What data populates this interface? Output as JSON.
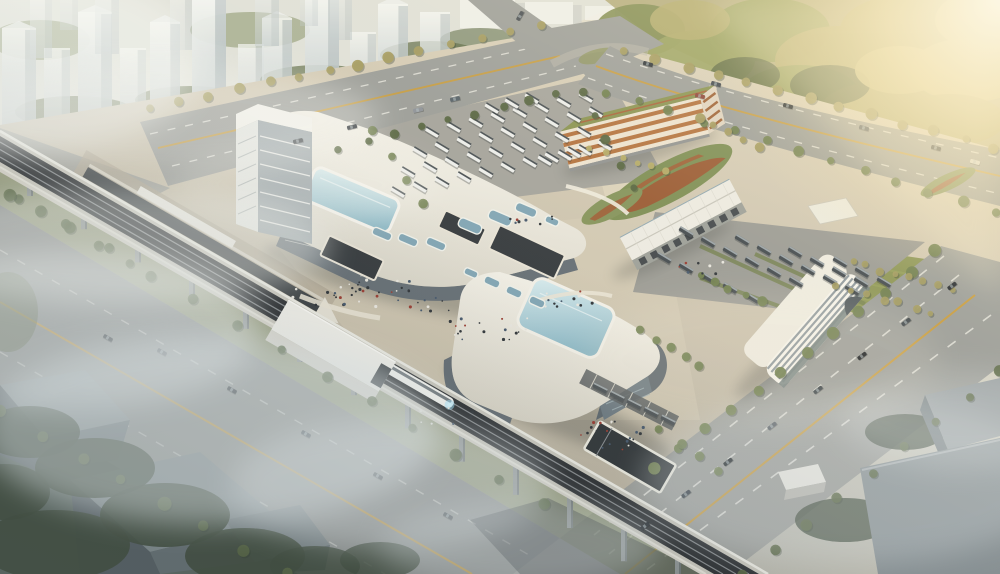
{
  "meta": {
    "label": "Aerial architectural rendering of an intermodal transit hub with two white terminal buildings, elevated railway viaduct with train, bus parking lots, parking garage, office block, roads, forest and hazy residential towers"
  },
  "palette": {
    "road": "#9a9c98",
    "roadDark": "#8b8e8c",
    "yellow": "#c79b3e",
    "dash": "#e8e7e0",
    "plazaHi": "#dcd2ba",
    "plazaLo": "#b8b1a1",
    "asphalt": "#a3a29b",
    "asphalt2": "#9a9a94",
    "grass": "#87914f",
    "grassDark": "#6f7c48",
    "treeDark": "#55643f",
    "treeDark2": "#3c4838",
    "treeMid": "#6e7d4c",
    "treeGold": "#a39a5e",
    "treeYellow": "#b5ab66",
    "f1": "#7f8a50",
    "f2": "#99a05f",
    "f3": "#b3ab6d",
    "f4": "#c7bb7a",
    "fSh": "#5a6741",
    "white": "#f2f1ea",
    "whiteDim": "#dcd9cf",
    "glass": "#646d74",
    "glassEnd": "#6b7880",
    "skyHi": "#d6e9ed",
    "skyLo": "#8fb9c6",
    "skylight": "#7fa4b4",
    "orange": "#b2703c",
    "track": "#2c2f32",
    "rail": "#85898c",
    "viaductSide": "#d5d2c8",
    "pier": "#8e9494",
    "busW": "#ecedeb",
    "busWTop": "#474e52",
    "busD": "#42494e",
    "busDTop": "#9aa3a7",
    "shed": "#eceae2",
    "shedFace": "#9b9e98",
    "door": "#41464a",
    "officeBand": "#8f999e",
    "towerSide": "#9aa6aa",
    "pit": "#33383c",
    "pitBorder": "#e8e3d6",
    "mound": "#7b8c52",
    "moundRed": "#9e4f2c"
  },
  "scene": {
    "towers": [
      [
        2,
        34,
        100,
        128,
        0.9,
        1
      ],
      [
        44,
        26,
        78,
        126,
        0.8,
        0
      ],
      [
        78,
        34,
        112,
        124,
        0.95,
        1
      ],
      [
        120,
        26,
        70,
        118,
        0.75,
        0
      ],
      [
        150,
        30,
        96,
        118,
        0.9,
        1
      ],
      [
        192,
        34,
        120,
        114,
        0.95,
        1
      ],
      [
        238,
        26,
        64,
        108,
        0.7,
        0
      ],
      [
        262,
        30,
        88,
        106,
        0.85,
        1
      ],
      [
        305,
        34,
        106,
        100,
        0.9,
        1
      ],
      [
        350,
        26,
        60,
        92,
        0.7,
        0
      ],
      [
        378,
        30,
        88,
        92,
        0.85,
        1
      ],
      [
        420,
        30,
        72,
        84,
        0.8,
        0
      ],
      [
        30,
        22,
        60,
        58,
        0.5,
        0
      ],
      [
        95,
        24,
        70,
        54,
        0.55,
        0
      ],
      [
        170,
        22,
        56,
        50,
        0.45,
        0
      ],
      [
        255,
        24,
        64,
        46,
        0.5,
        0
      ],
      [
        330,
        22,
        52,
        40,
        0.45,
        0
      ],
      [
        60,
        18,
        40,
        30,
        0.35,
        0
      ],
      [
        300,
        18,
        38,
        26,
        0.3,
        0
      ]
    ],
    "blocks": [
      [
        460,
        0,
        55,
        28
      ],
      [
        525,
        2,
        48,
        22
      ],
      [
        585,
        6,
        30,
        14
      ]
    ],
    "forest": [
      [
        640,
        30,
        45,
        26,
        "f1",
        0.95
      ],
      [
        700,
        60,
        55,
        30,
        "f2",
        0.95
      ],
      [
        770,
        30,
        60,
        32,
        "f2",
        0.95
      ],
      [
        840,
        60,
        65,
        34,
        "f3",
        0.95
      ],
      [
        910,
        30,
        70,
        36,
        "f3",
        0.95
      ],
      [
        970,
        70,
        60,
        32,
        "f4",
        0.95
      ],
      [
        720,
        110,
        55,
        26,
        "f1",
        0.95
      ],
      [
        800,
        95,
        60,
        30,
        "f2",
        0.95
      ],
      [
        880,
        110,
        60,
        28,
        "f3",
        0.95
      ],
      [
        950,
        120,
        55,
        26,
        "f3",
        0.95
      ],
      [
        660,
        90,
        40,
        22,
        "fSh",
        0.85
      ],
      [
        745,
        75,
        35,
        18,
        "fSh",
        0.8
      ],
      [
        830,
        85,
        40,
        20,
        "fSh",
        0.8
      ],
      [
        690,
        20,
        40,
        20,
        "f3",
        0.9
      ],
      [
        900,
        70,
        45,
        24,
        "f4",
        0.9
      ],
      [
        985,
        20,
        50,
        30,
        "f4",
        0.9
      ],
      [
        760,
        130,
        40,
        18,
        "f2",
        0.9
      ],
      [
        850,
        135,
        42,
        18,
        "f2",
        0.9
      ],
      [
        930,
        145,
        40,
        16,
        "f3",
        0.9
      ],
      [
        700,
        130,
        30,
        12,
        "f4",
        0.85
      ]
    ],
    "tree_rows": [
      [
        150,
        108,
        540,
        26,
        14,
        4.5,
        "treeGold",
        0.95
      ],
      [
        340,
        148,
        556,
        94,
        9,
        4,
        "treeDark",
        0.95
      ],
      [
        625,
        50,
        995,
        148,
        13,
        4.5,
        "treeGold",
        0.95
      ],
      [
        605,
        92,
        995,
        212,
        13,
        4.5,
        "treeMid",
        0.95
      ],
      [
        655,
        470,
        935,
        252,
        12,
        5,
        "treeMid",
        0.95
      ],
      [
        742,
        574,
        1000,
        372,
        9,
        5,
        "treeDark",
        0.9
      ],
      [
        20,
        198,
        545,
        505,
        13,
        5,
        "treeDark",
        0.85
      ],
      [
        0,
        412,
        286,
        572,
        8,
        5.5,
        "treeDark",
        0.9
      ],
      [
        372,
        132,
        425,
        204,
        4,
        4,
        "treeMid",
        0.9
      ],
      [
        582,
        92,
        632,
        188,
        5,
        4,
        "treeDark",
        0.95
      ],
      [
        852,
        262,
        952,
        290,
        8,
        3.5,
        "treeGold",
        0.9
      ],
      [
        838,
        286,
        930,
        312,
        7,
        3.5,
        "treeGold",
        0.9
      ],
      [
        590,
        148,
        668,
        172,
        6,
        3.5,
        "treeYellow",
        0.95
      ],
      [
        700,
        118,
        760,
        148,
        5,
        4,
        "treeGold",
        0.95
      ],
      [
        10,
        195,
        130,
        262,
        5,
        5,
        "treeDark",
        0.8
      ],
      [
        640,
        330,
        700,
        368,
        5,
        4.5,
        "treeMid",
        0.95
      ],
      [
        700,
        276,
        760,
        300,
        5,
        4,
        "treeMid",
        0.95
      ],
      [
        660,
        430,
        720,
        470,
        4,
        4,
        "treeMid",
        0.9
      ]
    ],
    "tree_blobs_bg": [
      [
        75,
        112,
        60,
        16,
        "treeDark",
        0.8
      ],
      [
        190,
        100,
        55,
        14,
        "treeDark",
        0.75
      ],
      [
        320,
        80,
        60,
        15,
        "treeDark",
        0.7
      ],
      [
        430,
        55,
        50,
        14,
        "treeDark",
        0.7
      ],
      [
        40,
        40,
        50,
        20,
        "treeMid",
        0.5
      ],
      [
        250,
        30,
        60,
        18,
        "treeMid",
        0.45
      ],
      [
        480,
        40,
        40,
        12,
        "treeDark",
        0.6
      ]
    ],
    "tree_blobs_dark": [
      [
        30,
        432,
        50,
        26,
        "treeDark2",
        0.92
      ],
      [
        95,
        468,
        60,
        30,
        "treeDark2",
        0.92
      ],
      [
        165,
        515,
        65,
        32,
        "treeDark2",
        0.92
      ],
      [
        245,
        556,
        60,
        28,
        "treeDark2",
        0.92
      ],
      [
        55,
        545,
        75,
        35,
        "treeDark2",
        0.92
      ],
      [
        5,
        492,
        45,
        28,
        "treeDark2",
        0.92
      ],
      [
        315,
        566,
        45,
        20,
        "treeDark2",
        0.85
      ],
      [
        380,
        560,
        40,
        18,
        "treeDark2",
        0.85
      ],
      [
        905,
        432,
        40,
        18,
        "treeDark2",
        0.85
      ],
      [
        965,
        468,
        45,
        20,
        "treeDark2",
        0.8
      ],
      [
        845,
        520,
        50,
        22,
        "treeDark2",
        0.8
      ],
      [
        8,
        312,
        30,
        40,
        "treeDark",
        0.5
      ]
    ],
    "bus_rows": [
      [
        398,
        192,
        22,
        -5,
        9,
        31,
        "w"
      ],
      [
        408,
        172,
        22,
        -5,
        9,
        31,
        "w"
      ],
      [
        420,
        152,
        22,
        -5,
        9,
        31,
        "w"
      ],
      [
        432,
        132,
        22,
        -5,
        8,
        31,
        "w"
      ],
      [
        545,
        160,
        20,
        -5,
        4,
        31,
        "w"
      ],
      [
        492,
        108,
        20,
        -5,
        3,
        31,
        "w"
      ],
      [
        686,
        232,
        22,
        10,
        6,
        31,
        "d"
      ],
      [
        742,
        240,
        22,
        10,
        6,
        31,
        "d"
      ],
      [
        795,
        252,
        22,
        10,
        4,
        31,
        "d"
      ],
      [
        840,
        262,
        22,
        10,
        3,
        31,
        "d"
      ],
      [
        664,
        258,
        22,
        10,
        5,
        31,
        "d"
      ],
      [
        600,
        388,
        17,
        8,
        5,
        27,
        "d"
      ]
    ],
    "skylights": [
      [
        382,
        234,
        20,
        8,
        23
      ],
      [
        408,
        240,
        20,
        8,
        23
      ],
      [
        436,
        244,
        20,
        8,
        23
      ],
      [
        470,
        226,
        24,
        10,
        23
      ],
      [
        500,
        218,
        24,
        10,
        23
      ],
      [
        526,
        210,
        22,
        9,
        23
      ],
      [
        552,
        221,
        14,
        7,
        23
      ],
      [
        492,
        282,
        16,
        8,
        24
      ],
      [
        514,
        292,
        16,
        8,
        24
      ],
      [
        537,
        302,
        16,
        8,
        24
      ],
      [
        471,
        273,
        14,
        7,
        24
      ]
    ],
    "cars": [
      [
        298,
        141,
        -13,
        "#3a4046"
      ],
      [
        352,
        127,
        -13,
        "#20262c"
      ],
      [
        455,
        99,
        -13,
        "#546068"
      ],
      [
        418,
        110,
        -13,
        "#8c9198"
      ],
      [
        520,
        16,
        -60,
        "#444a50"
      ],
      [
        648,
        64,
        15,
        "#2c3238"
      ],
      [
        716,
        84,
        15,
        "#3c444c"
      ],
      [
        788,
        106,
        15,
        "#1f252b"
      ],
      [
        864,
        128,
        15,
        "#4a525a"
      ],
      [
        936,
        148,
        15,
        "#2c3238"
      ],
      [
        700,
        96,
        15,
        "#8b4236"
      ],
      [
        975,
        162,
        15,
        "#d8d6d0"
      ],
      [
        952,
        286,
        -37,
        "#23282e"
      ],
      [
        906,
        322,
        -37,
        "#3a4248"
      ],
      [
        862,
        356,
        -37,
        "#14181c"
      ],
      [
        818,
        390,
        -37,
        "#2e363c"
      ],
      [
        772,
        426,
        -37,
        "#454d55"
      ],
      [
        728,
        462,
        -37,
        "#1d2327"
      ],
      [
        686,
        494,
        -37,
        "#303840"
      ],
      [
        645,
        526,
        -37,
        "#23282e"
      ],
      [
        108,
        338,
        30,
        "#2a3036"
      ],
      [
        162,
        352,
        30,
        "#3f464c"
      ],
      [
        232,
        390,
        30,
        "#23282e"
      ],
      [
        306,
        434,
        30,
        "#343c44"
      ],
      [
        378,
        476,
        30,
        "#282e34"
      ],
      [
        448,
        516,
        30,
        "#3a4146"
      ]
    ],
    "people": [
      [
        398,
        296,
        120,
        32,
        32
      ],
      [
        492,
        328,
        84,
        24,
        20
      ],
      [
        566,
        300,
        56,
        18,
        12
      ],
      [
        612,
        428,
        64,
        24,
        18
      ],
      [
        534,
        220,
        48,
        12,
        9
      ],
      [
        320,
        298,
        56,
        18,
        10
      ],
      [
        448,
        416,
        56,
        16,
        9
      ],
      [
        700,
        268,
        50,
        14,
        8
      ],
      [
        620,
        444,
        40,
        12,
        8
      ]
    ],
    "piers": {
      "x0": 30,
      "y0": 186,
      "dx": 54,
      "dy": 31,
      "n": 13,
      "w": 6,
      "h0": 10,
      "hg": 2.2
    },
    "fog": [
      [
        70,
        330,
        190,
        80,
        0.5,
        "#eef2f2"
      ],
      [
        210,
        430,
        230,
        95,
        0.55,
        "#e4ebec"
      ],
      [
        390,
        485,
        160,
        65,
        0.4,
        "#e8eef0"
      ],
      [
        120,
        245,
        210,
        60,
        0.45,
        "#f2f4f0"
      ],
      [
        40,
        60,
        160,
        90,
        0.5,
        "#f4f6f2"
      ],
      [
        160,
        120,
        220,
        55,
        0.35,
        "#f6f7f3"
      ],
      [
        850,
        480,
        210,
        85,
        0.3,
        "#dfe5e8"
      ],
      [
        960,
        420,
        120,
        50,
        0.25,
        "#e4e9ea"
      ],
      [
        520,
        545,
        140,
        45,
        0.35,
        "#dde4e6"
      ],
      [
        305,
        185,
        130,
        40,
        0.25,
        "#f6f6f0"
      ],
      [
        760,
        360,
        180,
        70,
        0.15,
        "#f2ead8"
      ]
    ]
  }
}
